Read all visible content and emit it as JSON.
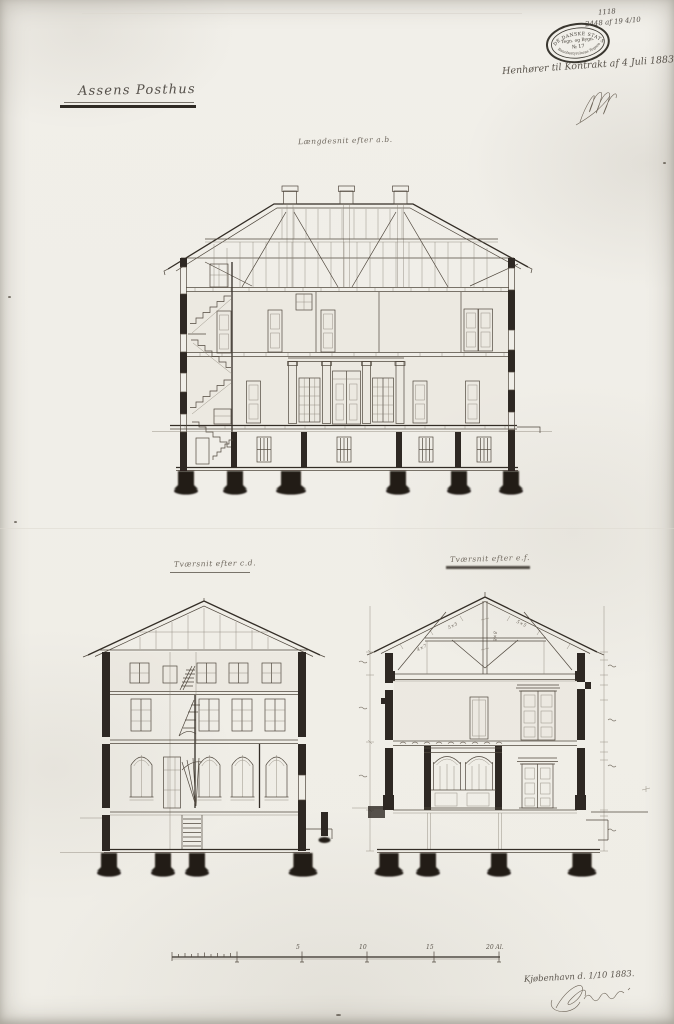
{
  "document": {
    "title": "Assens Posthus",
    "archive_note": {
      "line1": "1118",
      "line2": "2448 af 19 4/10"
    },
    "contract_note": "Henhører til Kontrakt af 4 Juli 1883.",
    "stamp": {
      "top_arc": "DE DANSKE STATSBANER",
      "line1": "Tegn. og Bygn.",
      "line2": "№ 17",
      "bottom_arc": "Banebestyrelsens Tegnearkiv"
    },
    "place_date": "Kjøbenhavn d. 1/10 1883."
  },
  "drawings": {
    "longitudinal": {
      "caption": "Længdesnit efter a.b."
    },
    "cross_cd": {
      "caption": "Tværsnit efter c.d."
    },
    "cross_ef": {
      "caption": "Tværsnit efter e.f."
    },
    "truss_notes": [
      "5×5",
      "4×7",
      "8×8",
      "5×5"
    ]
  },
  "scale_bar": {
    "tick_labels": [
      "5",
      "10",
      "15",
      "20 Al."
    ]
  },
  "colors": {
    "paper": "#f1efe9",
    "ink": "#474139",
    "poche": "#2b2520"
  }
}
